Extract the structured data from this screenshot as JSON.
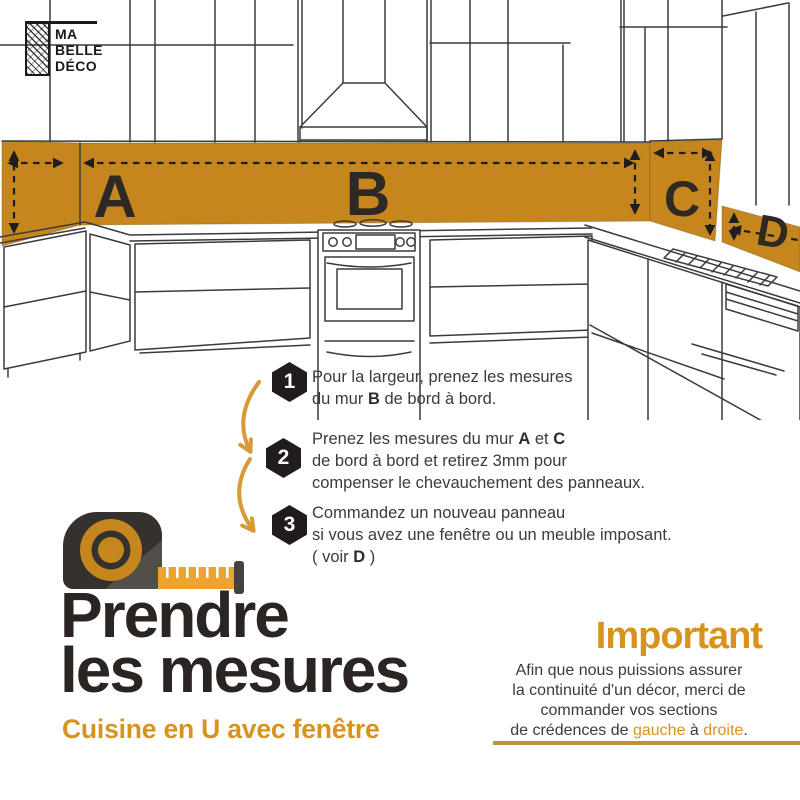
{
  "colors": {
    "accent": "#c6861e",
    "accent-bright": "#d8931d",
    "arrow": "#d79a35",
    "tape": "#eba42d",
    "tape-dark": "#34312e",
    "ink": "#3b3b3b",
    "title-ink": "#2a2523",
    "letter-ink": "#2e2925",
    "badge-bg": "#1f1c1b",
    "sketch": "#3b3b3b",
    "dash": "#1e1e1e",
    "gold-line": "#bd9434"
  },
  "logo": {
    "line1": "MA",
    "line2": "BELLE",
    "line3": "DÉCO"
  },
  "diagram": {
    "labels": {
      "a": "A",
      "b": "B",
      "c": "C",
      "d": "D"
    }
  },
  "steps": [
    {
      "number": "1",
      "lines": [
        "Pour la largeur, prenez les mesures",
        "du mur **B** de bord à bord."
      ]
    },
    {
      "number": "2",
      "lines": [
        "Prenez les mesures du mur **A** et **C**",
        "de bord à bord et retirez 3mm pour",
        "compenser le chevauchement des panneaux."
      ]
    },
    {
      "number": "3",
      "lines": [
        "Commandez un nouveau panneau",
        "si vous avez une fenêtre ou un meuble imposant.",
        "( voir **D** )"
      ]
    }
  ],
  "title": {
    "line1": "Prendre",
    "line2": "les mesures",
    "subtitle": "Cuisine en U avec fenêtre"
  },
  "important": {
    "heading": "Important",
    "lines": [
      "Afin que nous puissions assurer",
      "la continuité d'un décor, merci de",
      "commander vos sections",
      "de crédences de [[gauche]] à [[droite]]."
    ]
  }
}
